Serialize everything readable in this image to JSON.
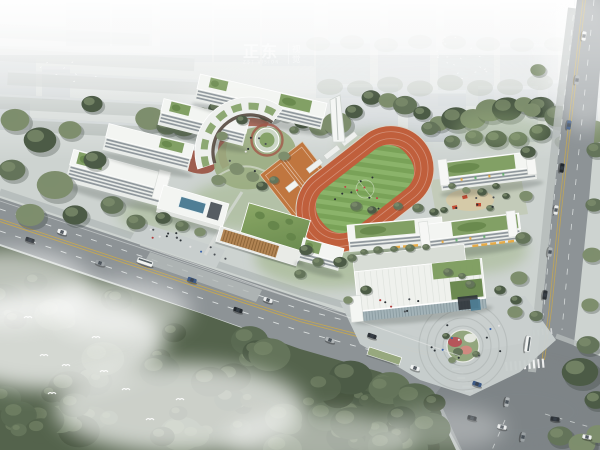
{
  "watermark": {
    "brand": "正东",
    "vertical_text": "视觉",
    "tagline": "ZST VISION"
  },
  "scene": {
    "type": "aerial-architectural-rendering",
    "subject": "school-campus-masterplan",
    "regions": [
      "city-skyline",
      "tree-belt",
      "roadside-forest",
      "main-road",
      "right-road",
      "road-intersection",
      "campus-grounds",
      "running-track",
      "football-field",
      "sports-courts",
      "arc-building",
      "teaching-buildings",
      "courtyard-garden",
      "glass-pavilion",
      "rooftop-pool",
      "gymnasium",
      "entrance-canopy",
      "entrance-plaza",
      "kindergarten-buildings",
      "performing-arts-center",
      "circular-plaza",
      "mist",
      "birds",
      "vehicles",
      "pedestrians"
    ]
  },
  "palette": {
    "sky": "#f0f2f2",
    "ground": "#cdd3d0",
    "city": "#b2bbc0",
    "cityTop": "#cdd4d7",
    "slabGray": "#a6afab",
    "treeDark": "#4c5b46",
    "treeMid": "#64745a",
    "treeLight": "#7e8e6d",
    "forest": "#54634c",
    "road": "#8d9396",
    "roadDark": "#7e8487",
    "sidewalk": "#b5bbba",
    "laneWhite": "#eef1f0",
    "laneYellow": "#c9a84c",
    "lawn": "#9ab17f",
    "plaza": "#c8cecd",
    "track": "#c05f3c",
    "field1": "#79a258",
    "field2": "#8cb46b",
    "court": "#c0763f",
    "roofWhite": "#f3f5f2",
    "facade": "#e9ece9",
    "window": "#6d7780",
    "roofGreen": "#7b9b5d",
    "roofGreenDk": "#648449",
    "wood": "#b18453",
    "woodDk": "#8e6639",
    "redPath": "#a25848",
    "terrace": "#99503f",
    "water": "#4f7e95",
    "glass": "#a3b3b8",
    "awning": "#e7a63a",
    "playRed": "#c24b33",
    "flower": "#b5565a",
    "flowerLight": "#cf8a80",
    "shadow": "#2e3833",
    "white": "#ffffff",
    "people": "#2c3236"
  }
}
